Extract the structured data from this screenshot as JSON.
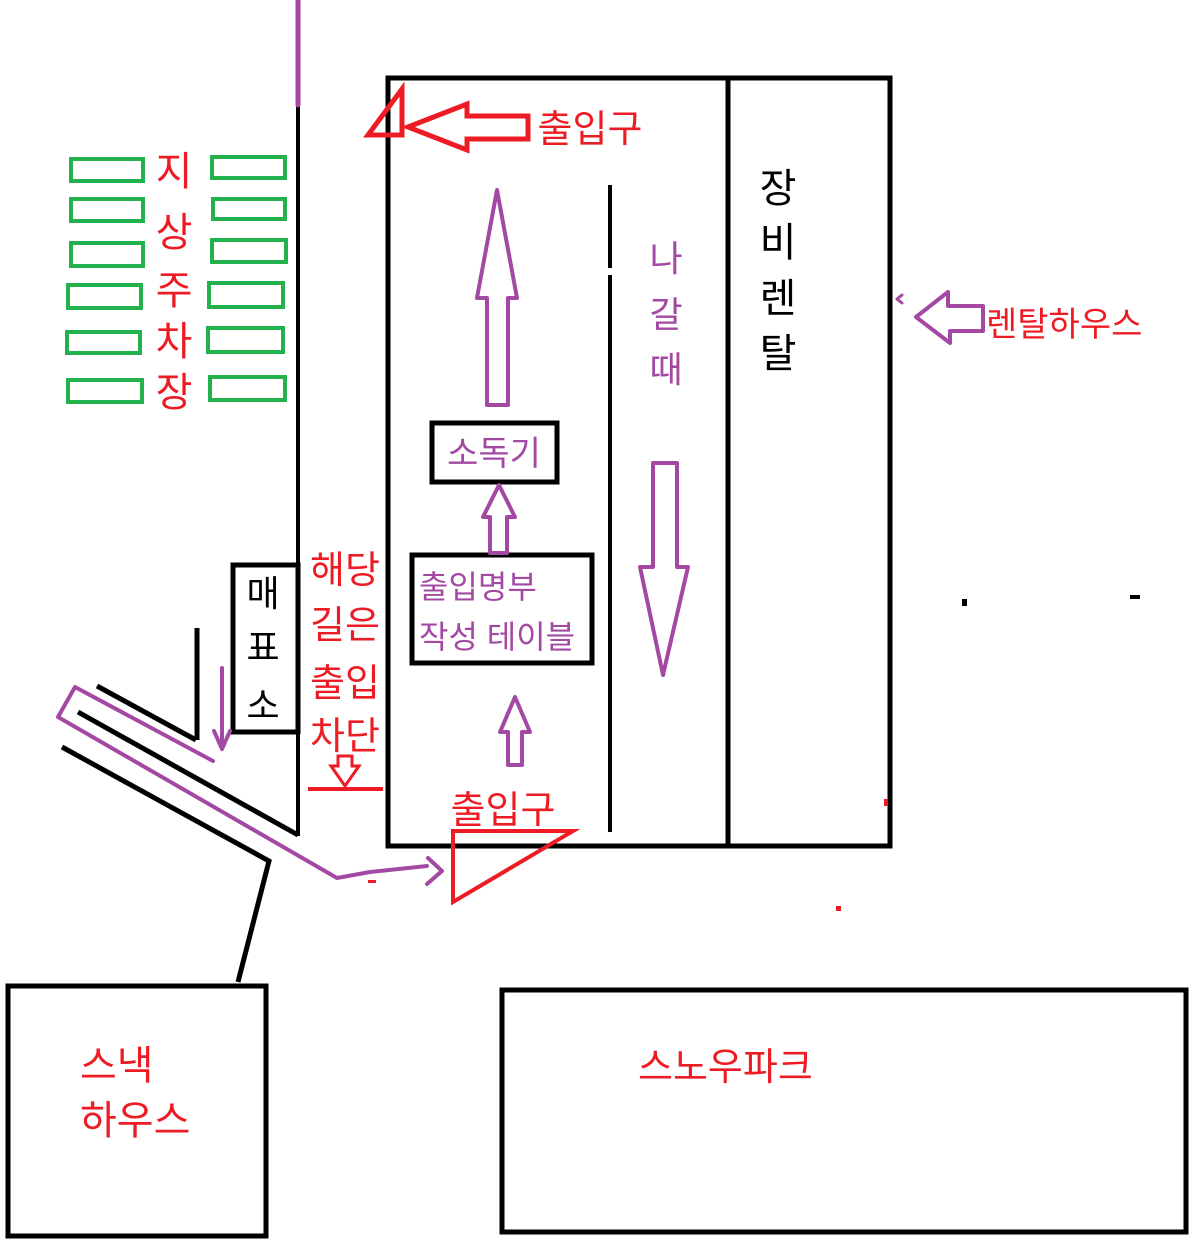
{
  "palette": {
    "red": "#ed1c24",
    "green": "#22b14c",
    "purple": "#a349a4",
    "black": "#000000",
    "white": "#ffffff"
  },
  "parking": {
    "label_chars": [
      "지",
      "상",
      "주",
      "차",
      "장"
    ]
  },
  "building": {
    "equipment_rental_chars": [
      "장",
      "비",
      "렌",
      "탈"
    ],
    "exit_lane_chars": [
      "나",
      "갈",
      "때"
    ],
    "sanitizer_label": "소독기",
    "entry_table_line1": "출입명부",
    "entry_table_line2": "작성 테이블"
  },
  "entrances": {
    "top_label": "출입구",
    "bottom_label": "출입구"
  },
  "rental_house_label": "렌탈하우스",
  "ticket_office_chars": [
    "매",
    "표",
    "소"
  ],
  "blocked_path": {
    "lines": [
      "해당",
      "길은",
      "출입",
      "차단"
    ]
  },
  "snack_house": {
    "line1": "스낵",
    "line2": "하우스"
  },
  "snow_park_label": "스노우파크"
}
